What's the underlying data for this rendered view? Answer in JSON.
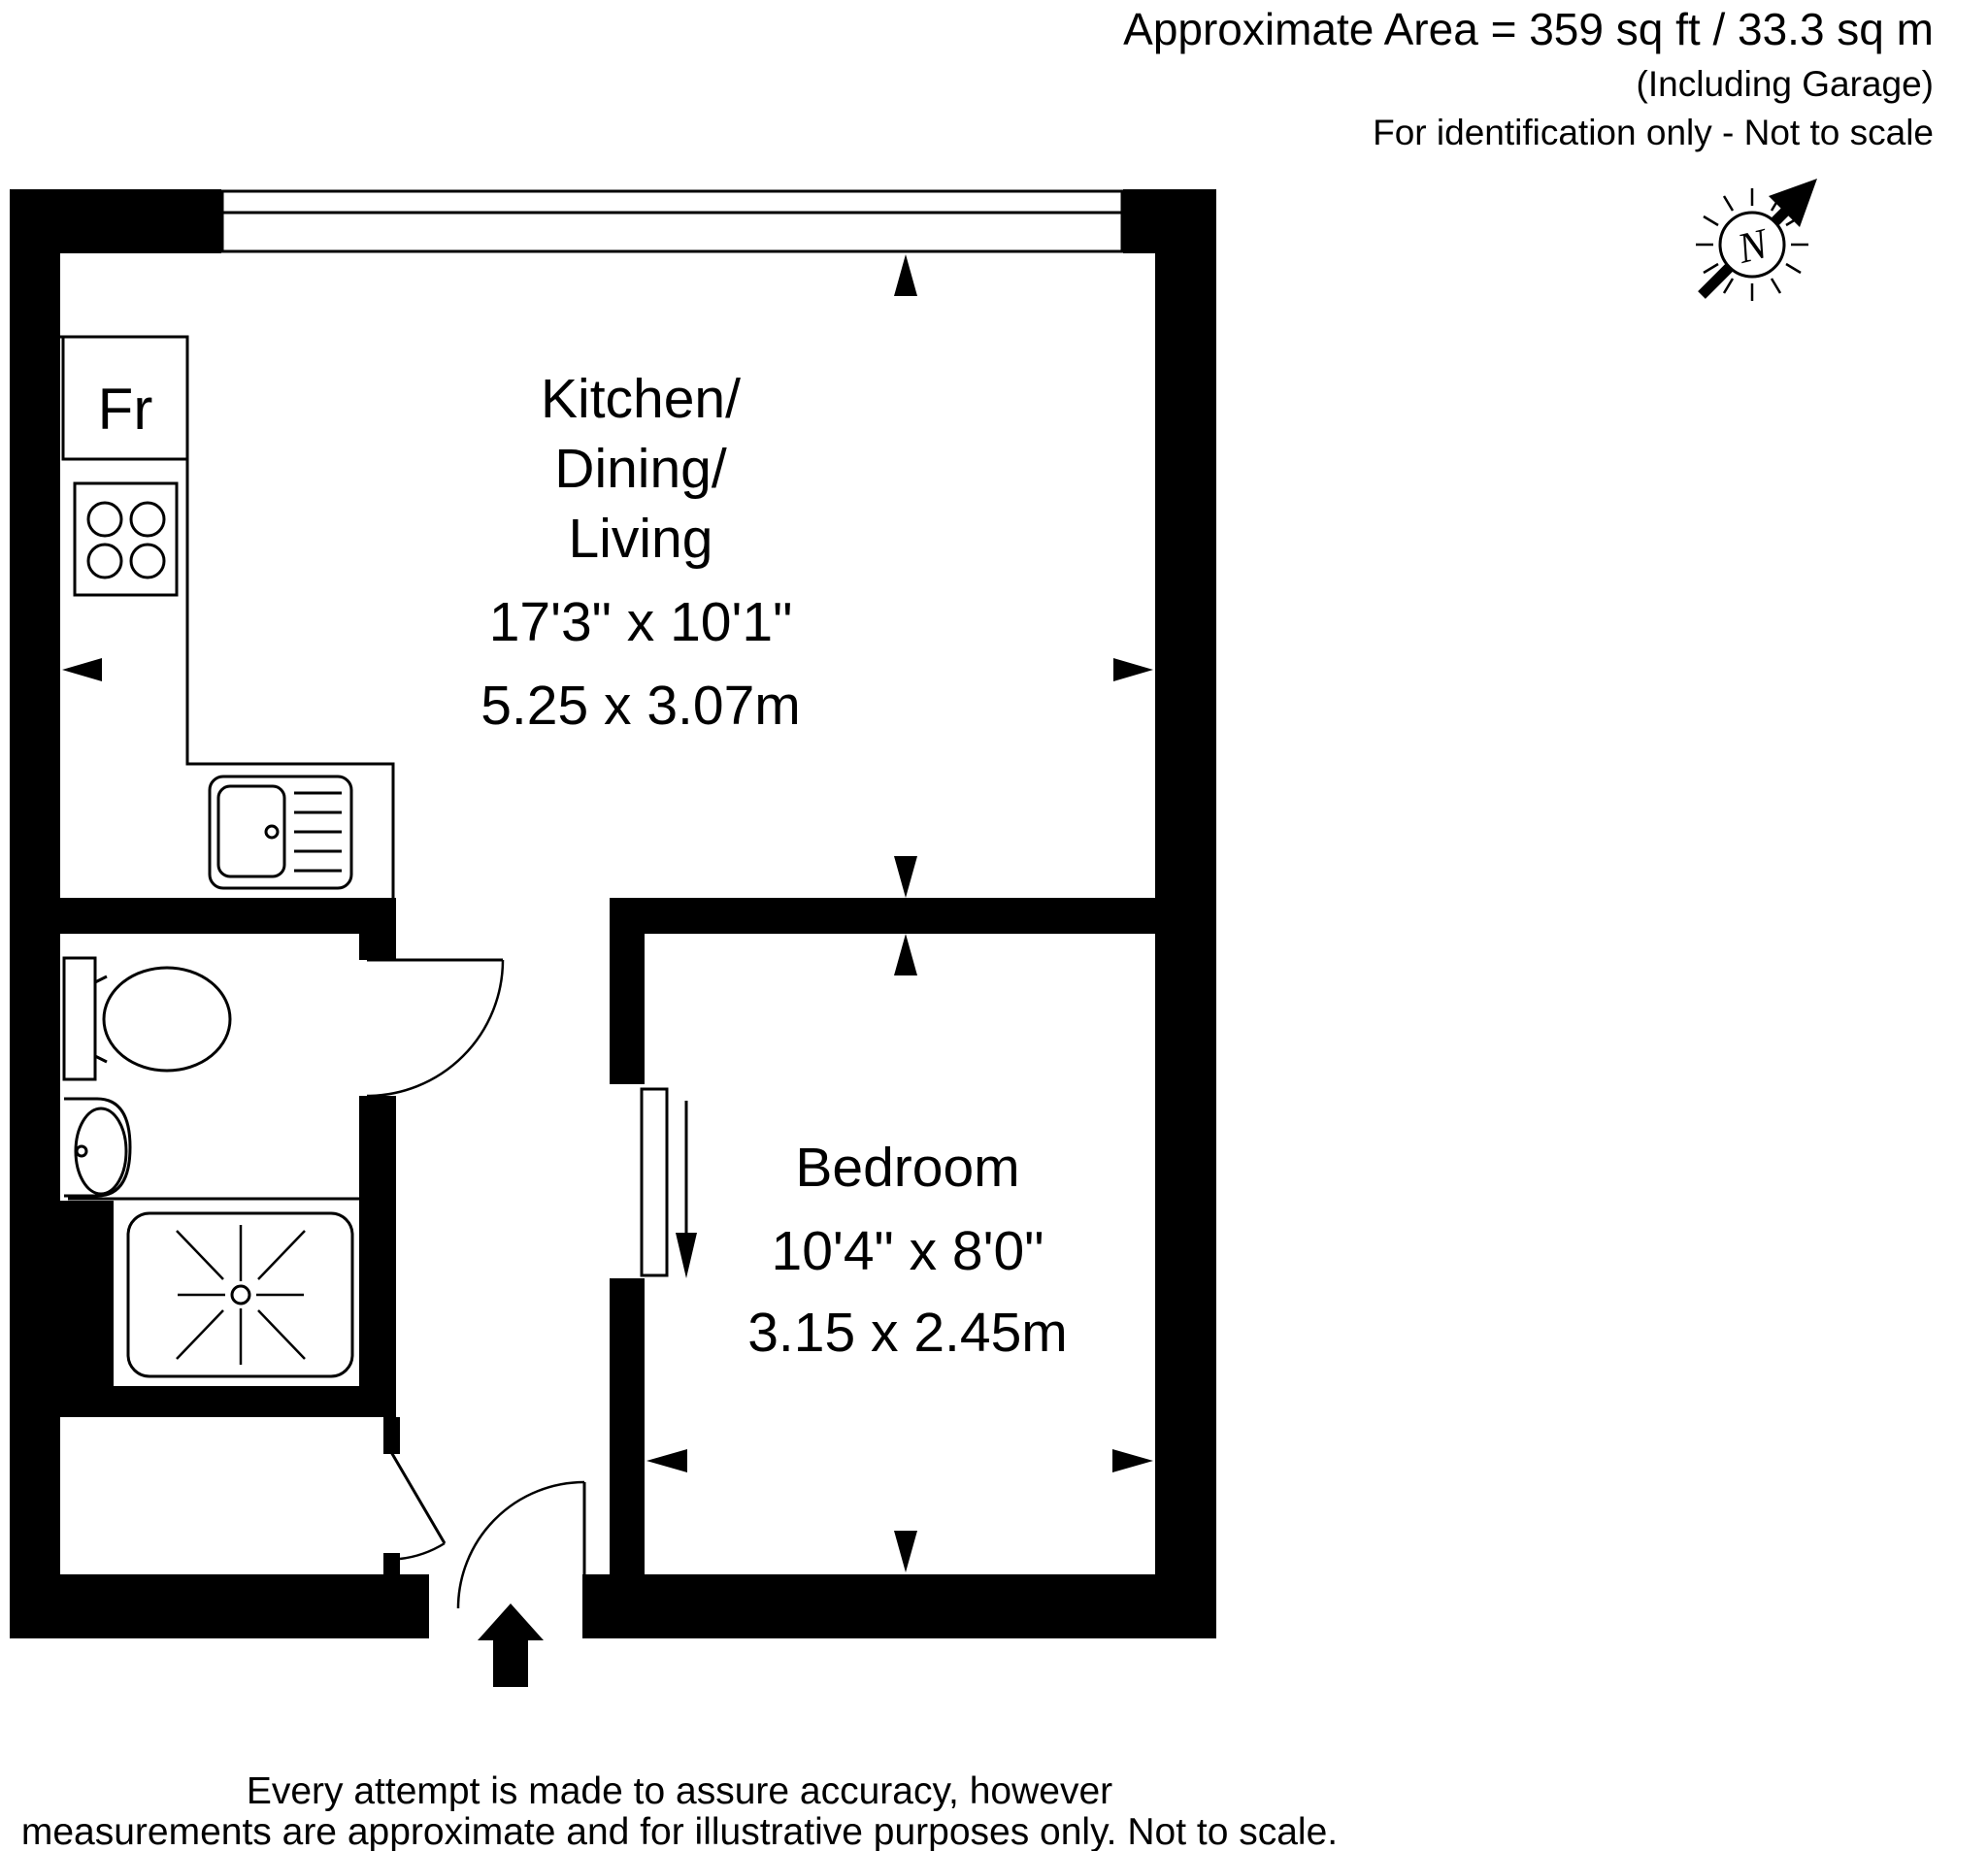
{
  "header": {
    "area": "Approximate Area = 359 sq ft / 33.3 sq m",
    "including": "(Including Garage)",
    "identification": "For identification only - Not to scale"
  },
  "north_indicator": {
    "label": "N"
  },
  "floor_plan": {
    "rooms": {
      "kitchen_dining_living": {
        "name_line1": "Kitchen/",
        "name_line2": "Dining/",
        "name_line3": "Living",
        "size_imperial": "17'3\" x 10'1\"",
        "size_metric": "5.25 x 3.07m"
      },
      "bedroom": {
        "name": "Bedroom",
        "size_imperial": "10'4\" x 8'0\"",
        "size_metric": "3.15 x 2.45m"
      }
    },
    "fixtures": {
      "fridge_label": "Fr"
    }
  },
  "footer": {
    "line1": "Every attempt is made to assure accuracy, however",
    "line2": "measurements are approximate and for illustrative purposes only. Not to scale."
  },
  "colors": {
    "wall": "#000000",
    "background": "#ffffff"
  }
}
